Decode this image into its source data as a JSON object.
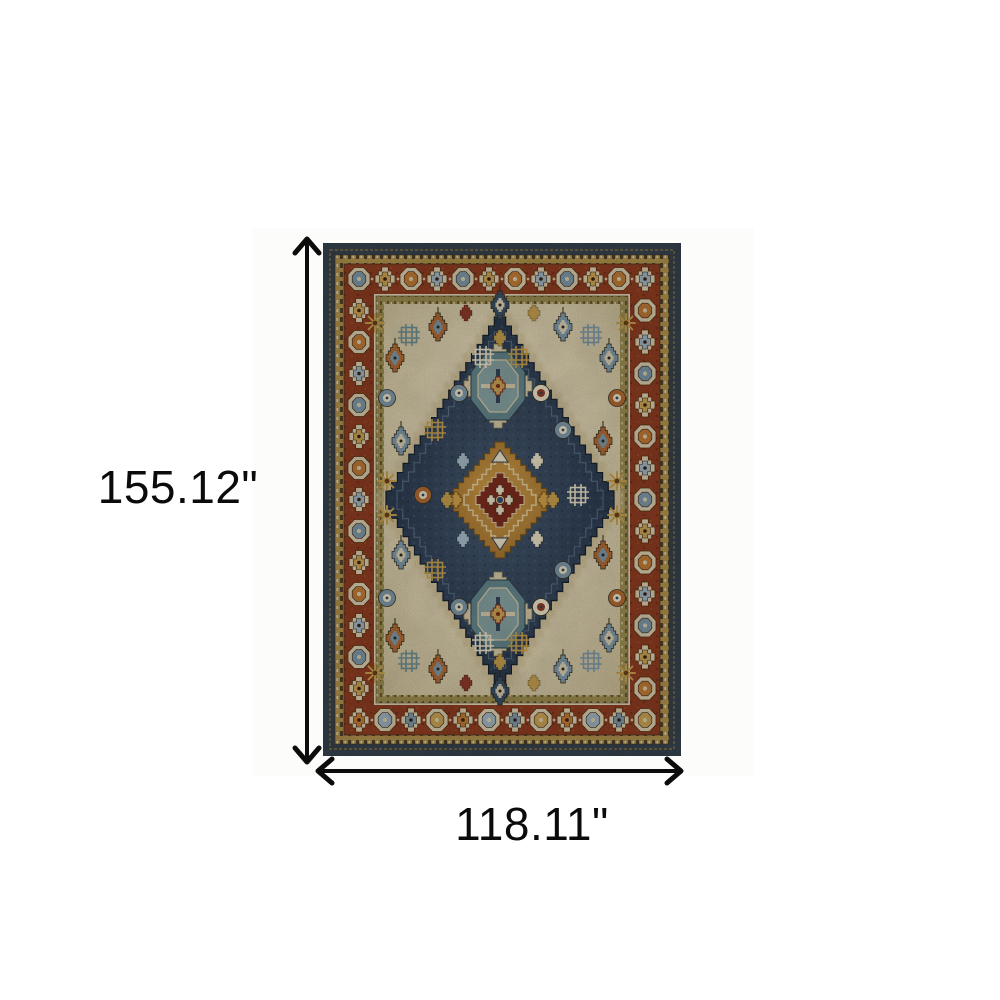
{
  "figure": {
    "type": "product-dimension-diagram",
    "height_label": "155.12\"",
    "width_label": "118.11\"",
    "arrow_color": "#0b0b0b",
    "background_color": "#ffffff"
  },
  "icons": {
    "height_arrow": "double-headed-vertical-arrow",
    "width_arrow": "double-headed-horizontal-arrow"
  },
  "rug": {
    "description": "Blue rust and gold oriental medallion area rug",
    "colors": {
      "outer_band": "#36434f",
      "outer_band_dark": "#26323d",
      "stitch_gold": "#8a6f3c",
      "gold_band": "#b0914d",
      "gold_band_dark": "#4e4129",
      "rust_border": "#8e3d22",
      "rust_border_dark": "#722e18",
      "rust_border_light": "#a0522d",
      "ring_cream": "#d9ccae",
      "olive_band": "#9c8c50",
      "olive_band_dark": "#655932",
      "cream_line": "#ddd2b2",
      "field_light": "#e7dcc0",
      "field_mid": "#dbcfae",
      "field_dark": "#c9bb95",
      "halo_tan": "#c8b78c",
      "navy_light": "#45596f",
      "navy_mid": "#344459",
      "navy_dark": "#263447",
      "navy_line": "#18222e",
      "diamond_outline_light": "#5e7589",
      "teal_main": "#64868b",
      "teal_light": "#86a1a0",
      "gold_main": "#c69f4e",
      "gold_deep": "#a06f2c",
      "gold_bright": "#d2a04b",
      "gold_outline": "#6e4f1f",
      "red_center": "#7c2d1f",
      "accent_gold": "#c69f4e",
      "accent_blue": "#7e98a8",
      "accent_rust": "#b06a33",
      "accent_red": "#8e3b28",
      "accent_navy": "#3a4f66",
      "accent_teal": "#6d8d90",
      "accent_cream": "#e8dfc5",
      "accent_lightblue": "#a6bcc6",
      "border_center_1": "#7e98a8",
      "border_center_2": "#c9a254",
      "border_center_3": "#bf7a35",
      "border_center_4": "#9fb3c0"
    }
  }
}
